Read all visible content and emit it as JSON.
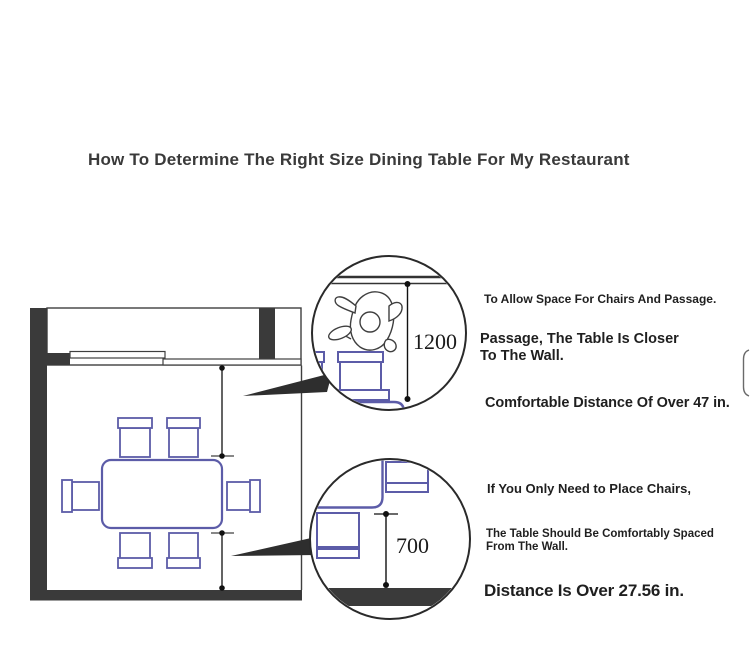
{
  "page": {
    "title": "How To Determine The Right Size Dining Table For My Restaurant"
  },
  "callout_top": {
    "dimension_mm": "1200",
    "note_small": "To Allow Space For Chairs And Passage.",
    "note_line1": "Passage, The Table Is Closer",
    "note_line2": "To The Wall.",
    "note_large": "Comfortable Distance Of Over 47 in."
  },
  "callout_bottom": {
    "dimension_mm": "700",
    "note_small": "If You Only Need to Place Chairs,",
    "note_line1": "The Table Should Be Comfortably Spaced",
    "note_line2": "From The Wall.",
    "note_large": "Distance Is Over 27.56 in."
  },
  "colors": {
    "furniture_outline": "#5c5ca8",
    "wall_fill": "#3a3a3a",
    "line": "#222222",
    "text": "#1f1f1f"
  }
}
